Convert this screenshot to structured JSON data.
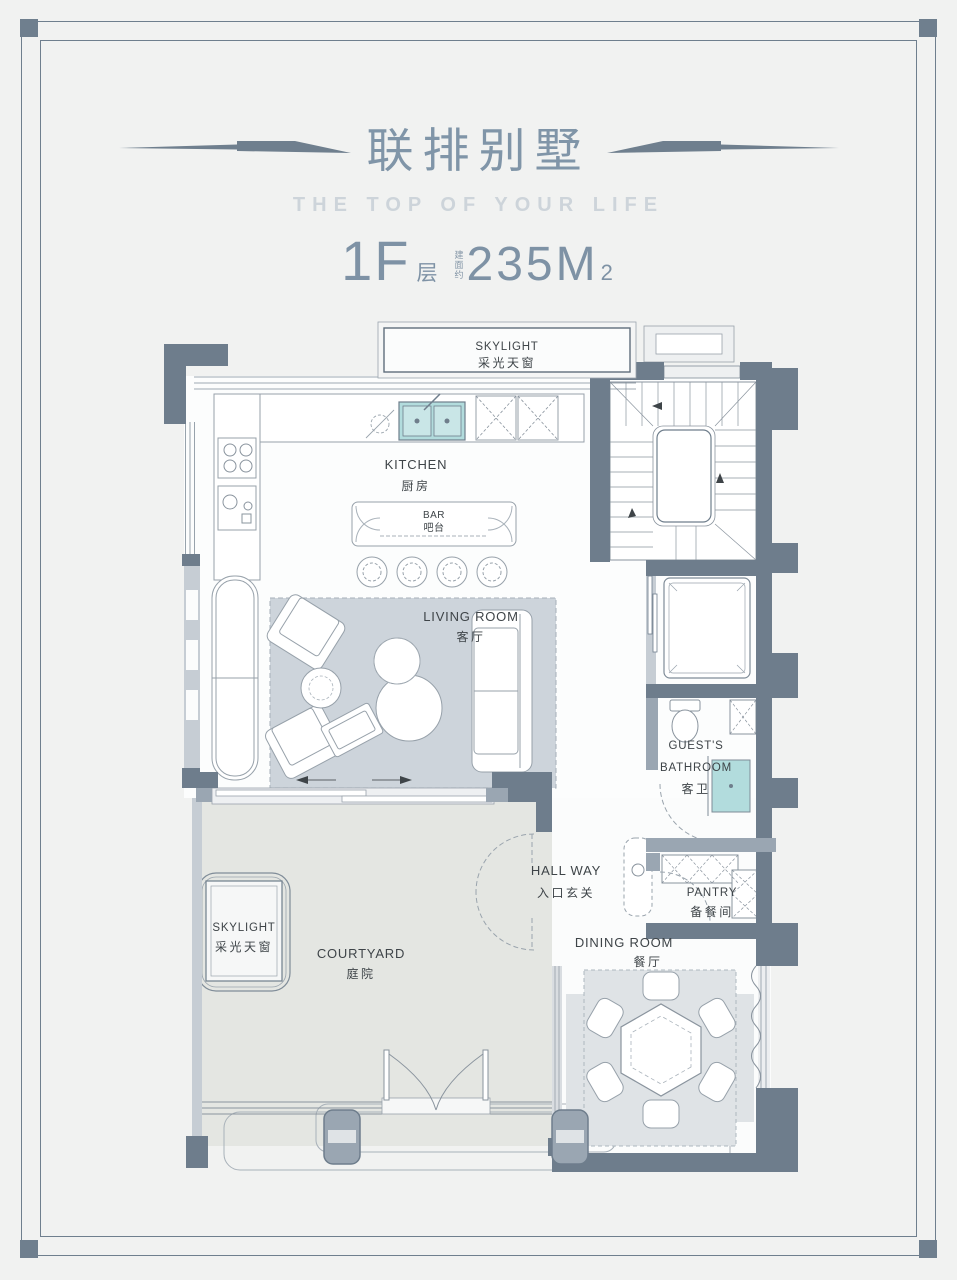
{
  "header": {
    "title": "联排别墅",
    "subtitle": "THE TOP OF YOUR LIFE",
    "floor": "1F",
    "floor_suffix": "层",
    "area_note": "建面约",
    "area": "235M",
    "area_sup": "2"
  },
  "plan": {
    "skylight_top": {
      "en": "SKYLIGHT",
      "cn": "采光天窗"
    },
    "kitchen": {
      "en": "KITCHEN",
      "cn": "厨房"
    },
    "bar": {
      "en": "BAR",
      "cn": "吧台"
    },
    "living_room": {
      "en": "LIVING ROOM",
      "cn": "客厅"
    },
    "guests_bathroom": {
      "en_line1": "GUEST'S",
      "en_line2": "BATHROOM",
      "cn": "客卫"
    },
    "hallway": {
      "en": "HALL WAY",
      "cn": "入口玄关"
    },
    "pantry": {
      "en": "PANTRY",
      "cn": "备餐间"
    },
    "dining_room": {
      "en": "DINING ROOM",
      "cn": "餐厅"
    },
    "courtyard": {
      "en": "COURTYARD",
      "cn": "庭院"
    },
    "skylight_courtyard": {
      "en": "SKYLIGHT",
      "cn": "采光天窗"
    }
  },
  "colors": {
    "accent_slate": "#6f7f8e",
    "title_blue": "#8095a8",
    "subtitle_gray": "#cdd4da",
    "wall_dark": "#6e7d8c",
    "wall_mid": "#9aa6b2",
    "water_teal": "#b2dcdd",
    "rug_gray": "#cdd4db"
  }
}
